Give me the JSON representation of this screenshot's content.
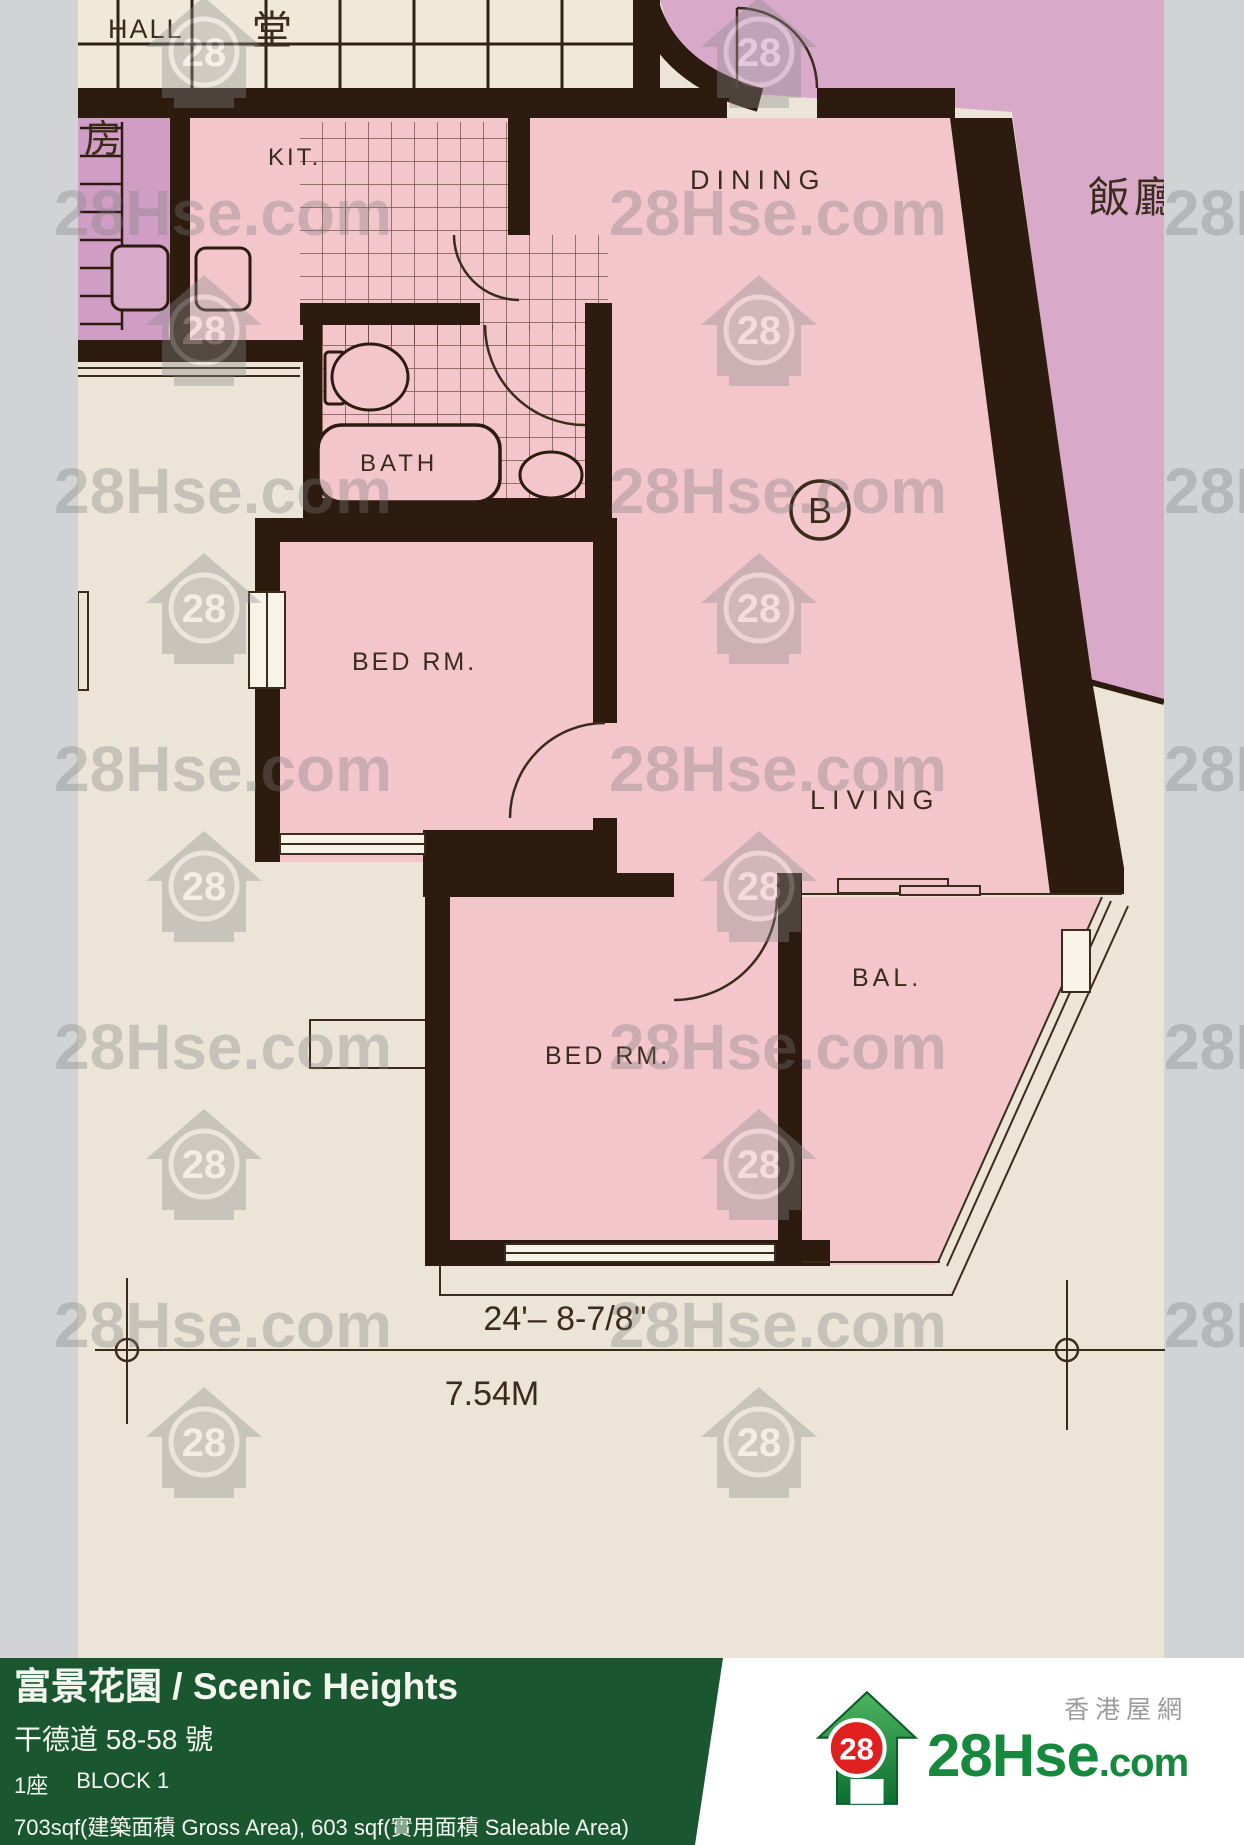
{
  "floor_plan": {
    "rooms": {
      "hall": "HALL",
      "hall_cn": "堂",
      "kitchen": "KIT.",
      "room_cn": "房",
      "dining": "DINING",
      "dining_cn": "飯廳",
      "bath": "BATH",
      "bedroom1": "BED RM.",
      "living": "LIVING",
      "balcony": "BAL.",
      "bedroom2": "BED RM.",
      "unit_label": "B"
    },
    "dimensions": {
      "imperial": "24'– 8-7/8''",
      "metric": "7.54M"
    }
  },
  "watermark": {
    "text": "28Hse.com",
    "badge": "28"
  },
  "footer": {
    "title": "富景花園 / Scenic Heights",
    "address": "干德道 58-58 號",
    "block_cn": "1座",
    "block_en": "BLOCK 1",
    "area": "703sqf(建築面積 Gross Area), 603 sqf(實用面積 Saleable Area)"
  },
  "logo": {
    "site": "28Hse",
    "domain": ".com",
    "badge": "28",
    "tagline": "香港屋網"
  },
  "colors": {
    "footer_green": "#1a5731",
    "logo_green": "#17893e",
    "logo_red": "#e01f1f",
    "unit_pink": "#f3c6cc",
    "neighbor_purple": "#d8a9c9",
    "wall_dark": "#2d1b10",
    "paper_cream": "#ece5d7",
    "side_gray": "#d2d3d5"
  }
}
